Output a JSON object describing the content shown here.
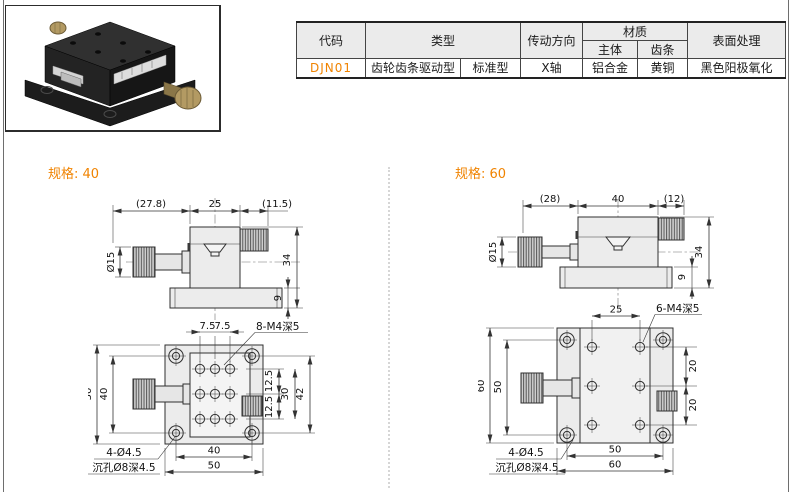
{
  "colors": {
    "accent": "#f08300",
    "table_header_bg": "#ebebeb",
    "drawing_fill": "#ececec",
    "brass": "#b39a63"
  },
  "table": {
    "h_code": "代码",
    "h_type": "类型",
    "h_direction": "传动方向",
    "h_material": "材质",
    "h_main": "主体",
    "h_rack": "齿条",
    "h_surface": "表面处理",
    "r_code": "DJN01",
    "r_type1": "齿轮齿条驱动型",
    "r_type2": "标准型",
    "r_direction": "X轴",
    "r_main": "铝合金",
    "r_rack": "黄铜",
    "r_surface": "黑色阳极氧化"
  },
  "spec40": {
    "label": "规格: 40",
    "side": {
      "d1": "(27.8)",
      "d2": "25",
      "d3": "(11.5)",
      "dia": "Ø15",
      "h": "34",
      "bh": "9"
    },
    "top": {
      "p1": "7.5",
      "p2": "7.5",
      "callout": "8-M4深5",
      "wo": "50",
      "wi": "40",
      "r1": "12.5",
      "r2": "12.5",
      "r3": "30",
      "r4": "42",
      "b1": "40",
      "b2": "50",
      "n1": "4-Ø4.5",
      "n2": "沉孔Ø8深4.5"
    }
  },
  "spec60": {
    "label": "规格: 60",
    "side": {
      "d1": "(28)",
      "d2": "40",
      "d3": "(12)",
      "dia": "Ø15",
      "h": "34",
      "bh": "9"
    },
    "top": {
      "p1": "25",
      "callout": "6-M4深5",
      "wo": "60",
      "wi": "50",
      "r1": "20",
      "r2": "20",
      "b1": "50",
      "b2": "60",
      "n1": "4-Ø4.5",
      "n2": "沉孔Ø8深4.5"
    }
  }
}
